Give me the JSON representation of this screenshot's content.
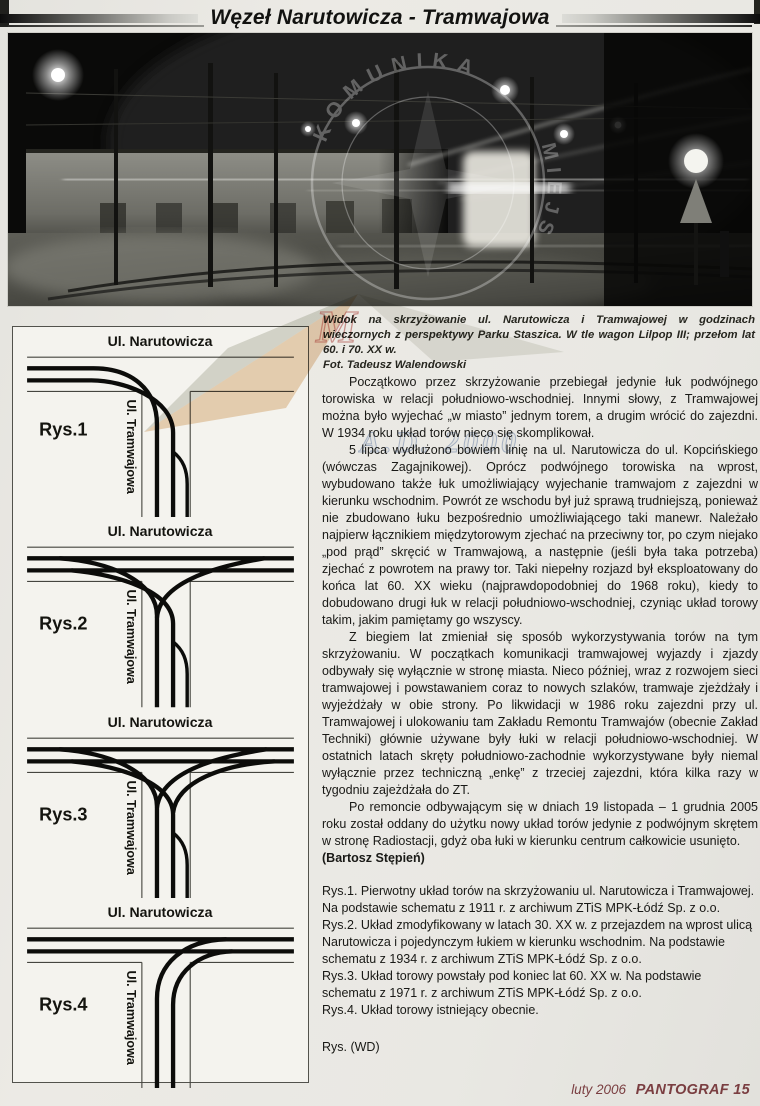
{
  "header": {
    "title": "Węzeł Narutowicza - Tramwajowa"
  },
  "photo": {
    "caption": "Widok na skrzyżowanie ul. Narutowicza i Tramwajowej w godzinach wieczornych z perspektywy Parku Staszica. W tle wagon Lilpop III; przełom lat 60. i 70. XX w.",
    "credit": "Fot. Tadeusz Walendowski",
    "watermark_top": "KOMUNIKA",
    "watermark_right": "MIEJS",
    "watermark_letter": "M",
    "watermark_year": "A.D. 2000"
  },
  "diagrams": {
    "street_h": "Ul. Narutowicza",
    "street_v": "Ul. Tramwajowa",
    "items": [
      {
        "label": "Rys.1"
      },
      {
        "label": "Rys.2"
      },
      {
        "label": "Rys.3"
      },
      {
        "label": "Rys.4"
      }
    ]
  },
  "article": {
    "p1": "Początkowo przez skrzyżowanie przebiegał jedynie łuk podwójnego torowiska w relacji południowo-wschodniej. Innymi słowy, z Tramwajowej można było wyjechać „w miasto” jednym torem, a drugim wrócić do zajezdni. W 1934 roku układ torów nieco się skomplikował.",
    "p2": "5 lipca wydłużono bowiem linię na ul. Narutowicza do ul. Kopcińskiego (wówczas Zagajnikowej). Oprócz podwójnego torowiska na wprost, wybudowano także łuk umożliwiający wyjechanie tramwajom z zajezdni w kierunku wschodnim. Powrót ze wschodu był już sprawą trudniejszą, ponieważ nie zbudowano łuku bezpośrednio umożliwiającego taki manewr. Należało najpierw łącznikiem międzytorowym zjechać na przeciwny tor, po czym niejako „pod prąd” skręcić w Tramwajową, a następnie (jeśli była taka potrzeba) zjechać z powrotem na prawy tor. Taki niepełny rozjazd był eksploatowany do końca lat 60. XX wieku (najprawdopodobniej do 1968 roku), kiedy to dobudowano drugi łuk w relacji południowo-wschodniej, czyniąc układ torowy takim, jakim pamiętamy go wszyscy.",
    "p3": "Z biegiem lat zmieniał się sposób wykorzystywania torów na tym skrzyżowaniu. W początkach komunikacji tramwajowej wyjazdy i zjazdy odbywały się wyłącznie w stronę miasta. Nieco później, wraz z rozwojem sieci tramwajowej i powstawaniem coraz to nowych szlaków, tramwaje zjeżdżały i wyjeżdżały w obie strony. Po likwidacji w 1986 roku zajezdni przy ul. Tramwajowej i ulokowaniu tam Zakładu Remontu Tramwajów (obecnie Zakład Techniki) głównie używane były łuki w relacji południowo-wschodniej. W ostatnich latach skręty południowo-zachodnie wykorzystywane były niemal wyłącznie przez techniczną „enkę” z trzeciej zajezdni, która kilka razy w tygodniu zajeżdżała do ZT.",
    "p4": "Po remoncie odbywającym się w dniach 19 listopada – 1 grudnia 2005 roku został oddany do użytku nowy układ torów jedynie z podwójnym skrętem w stronę Radiostacji, gdyż oba łuki w kierunku centrum całkowicie usunięto.",
    "byline": "(Bartosz Stępień)",
    "figure_notes": [
      "Rys.1. Pierwotny układ torów na skrzyżowaniu ul. Narutowicza i Tramwajowej. Na podstawie schematu z 1911 r. z archiwum ZTiS MPK-Łódź Sp. z o.o.",
      "Rys.2. Układ zmodyfikowany w latach 30. XX w. z przejazdem na wprost ulicą Narutowicza i pojedynczym łukiem w kierunku wschodnim. Na podstawie schematu z 1934 r. z archiwum ZTiS MPK-Łódź Sp. z o.o.",
      "Rys.3. Układ torowy powstały pod koniec lat 60. XX w. Na podstawie schematu z 1971 r. z archiwum ZTiS MPK-Łódź Sp. z o.o.",
      "Rys.4. Układ torowy istniejący obecnie."
    ],
    "drawings_credit": "Rys. (WD)"
  },
  "footer": {
    "issue": "luty 2006",
    "brand": "PANTOGRAF 15"
  },
  "colors": {
    "footer_text": "#7a3e41",
    "page_bg": "#e9e8e3",
    "watermark_orange": "#d9a568",
    "watermark_red": "#b5413a",
    "watermark_blue": "#8fa3c6"
  }
}
